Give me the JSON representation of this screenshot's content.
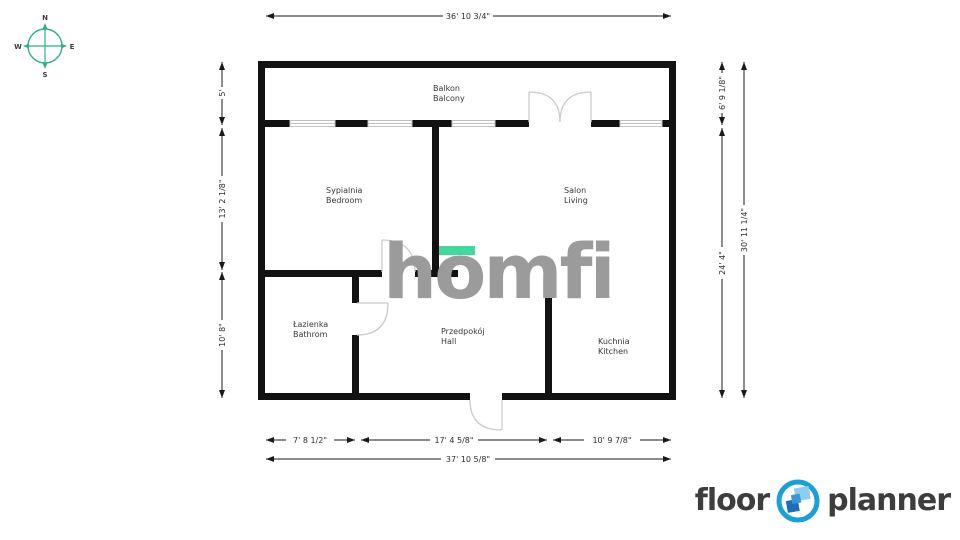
{
  "colors": {
    "wall-black": "#121212",
    "compass-teal": "#2fae8e",
    "accent-green": "#42d89e",
    "watermark-gray": "#9b9b9b",
    "brand-blue": "#18a0d7"
  },
  "compass": {
    "north": "N",
    "south": "S",
    "west": "W",
    "east": "E"
  },
  "rooms": [
    {
      "name_pl": "Balkon",
      "name_en": "Balcony"
    },
    {
      "name_pl": "Sypialnia",
      "name_en": "Bedroom"
    },
    {
      "name_pl": "Salon",
      "name_en": "Living"
    },
    {
      "name_pl": "Łazienka",
      "name_en": "Bathrom"
    },
    {
      "name_pl": "Przedpokój",
      "name_en": "Hall"
    },
    {
      "name_pl": "Kuchnia",
      "name_en": "Kitchen"
    }
  ],
  "dimensions": {
    "top_total": "36' 10 3/4\"",
    "left": [
      "5'",
      "13' 2 1/8\"",
      "10' 8\""
    ],
    "right_inner": [
      "6' 9 1/8\"",
      "24' 4\""
    ],
    "right_total": "30' 11 1/4\"",
    "bottom": [
      "7' 8 1/2\"",
      "17' 4 5/8\"",
      "10' 9 7/8\""
    ],
    "bottom_total": "37' 10 5/8\""
  },
  "watermark": {
    "p1": "h",
    "p2": "o",
    "p3": "mfi"
  },
  "brand": {
    "word1": "floor",
    "word2": "planner"
  }
}
